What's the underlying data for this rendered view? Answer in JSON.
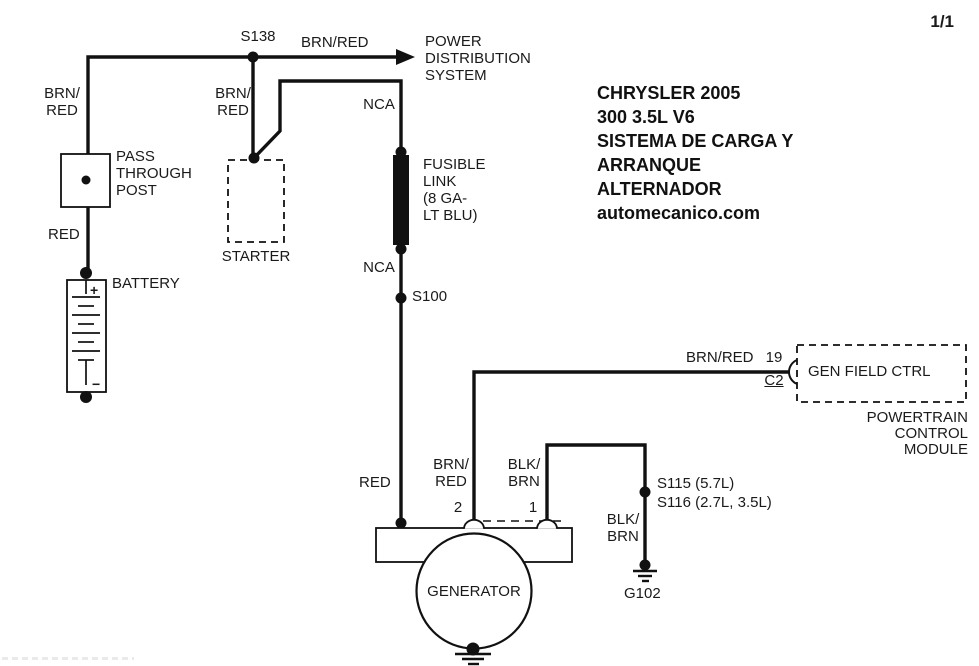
{
  "page": {
    "indicator": "1/1"
  },
  "title": {
    "lines": [
      "CHRYSLER 2005",
      "300 3.5L V6",
      "SISTEMA DE CARGA Y",
      "ARRANQUE",
      "ALTERNADOR",
      "automecanico.com"
    ]
  },
  "colors": {
    "wire": "#111111",
    "background": "#ffffff",
    "text": "#1a1a1a"
  },
  "components": {
    "power_distribution": {
      "lines": [
        "POWER",
        "DISTRIBUTION",
        "SYSTEM"
      ]
    },
    "pass_through_post": {
      "lines": [
        "PASS",
        "THROUGH",
        "POST"
      ]
    },
    "battery": {
      "label": "BATTERY",
      "plus": "+",
      "minus": "−"
    },
    "starter": {
      "label": "STARTER"
    },
    "fusible_link": {
      "lines": [
        "FUSIBLE",
        "LINK",
        "(8 GA-",
        "LT BLU)"
      ]
    },
    "generator": {
      "label": "GENERATOR",
      "pin_2": "2",
      "pin_1": "1"
    },
    "pcm": {
      "connector_label": "GEN FIELD CTRL",
      "pin": "19",
      "connector": "C2",
      "lines": [
        "POWERTRAIN",
        "CONTROL",
        "MODULE"
      ]
    }
  },
  "splices": {
    "s138": "S138",
    "s100": "S100",
    "s115": "S115 (5.7L)",
    "s116": "S116 (2.7L, 3.5L)"
  },
  "grounds": {
    "g102": "G102"
  },
  "wire_labels": {
    "brn_red_battery": {
      "lines": [
        "BRN/",
        "RED"
      ]
    },
    "brn_red_starter": {
      "lines": [
        "BRN/",
        "RED"
      ]
    },
    "brn_red_pds": "BRN/RED",
    "nca_upper": "NCA",
    "nca_lower": "NCA",
    "red_battery": "RED",
    "red_generator": "RED",
    "brn_red_field": {
      "lines": [
        "BRN/",
        "RED"
      ]
    },
    "brn_red_pcm": "BRN/RED",
    "blk_brn_generator": {
      "lines": [
        "BLK/",
        "BRN"
      ]
    },
    "blk_brn_ground": {
      "lines": [
        "BLK/",
        "BRN"
      ]
    }
  }
}
